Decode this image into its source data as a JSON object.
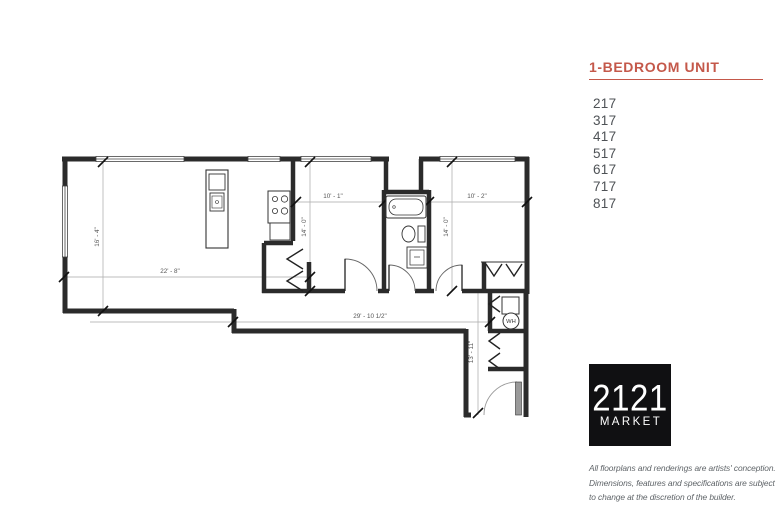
{
  "panel": {
    "title": "1-BEDROOM UNIT",
    "accent_color": "#c4584a",
    "units": [
      "217",
      "317",
      "417",
      "517",
      "617",
      "717",
      "817"
    ],
    "logo": {
      "name": "2121",
      "sub": "MARKET"
    },
    "disclaimer": [
      "All floorplans and renderings are artists' conception.",
      "Dimensions, features and specifications are subject",
      "to change at the discretion of the builder."
    ]
  },
  "floorplan": {
    "dims": {
      "living_w": "22' - 8\"",
      "living_h": "16' - 4\"",
      "bed1_w": "10' - 1\"",
      "bed1_h": "14' - 0\"",
      "bed2_w": "10' - 2\"",
      "bed2_h": "14' - 0\"",
      "overall_w": "29' - 10 1/2\"",
      "hall_h": "13' - 11\""
    },
    "labels": {
      "water_heater": "WH"
    }
  }
}
